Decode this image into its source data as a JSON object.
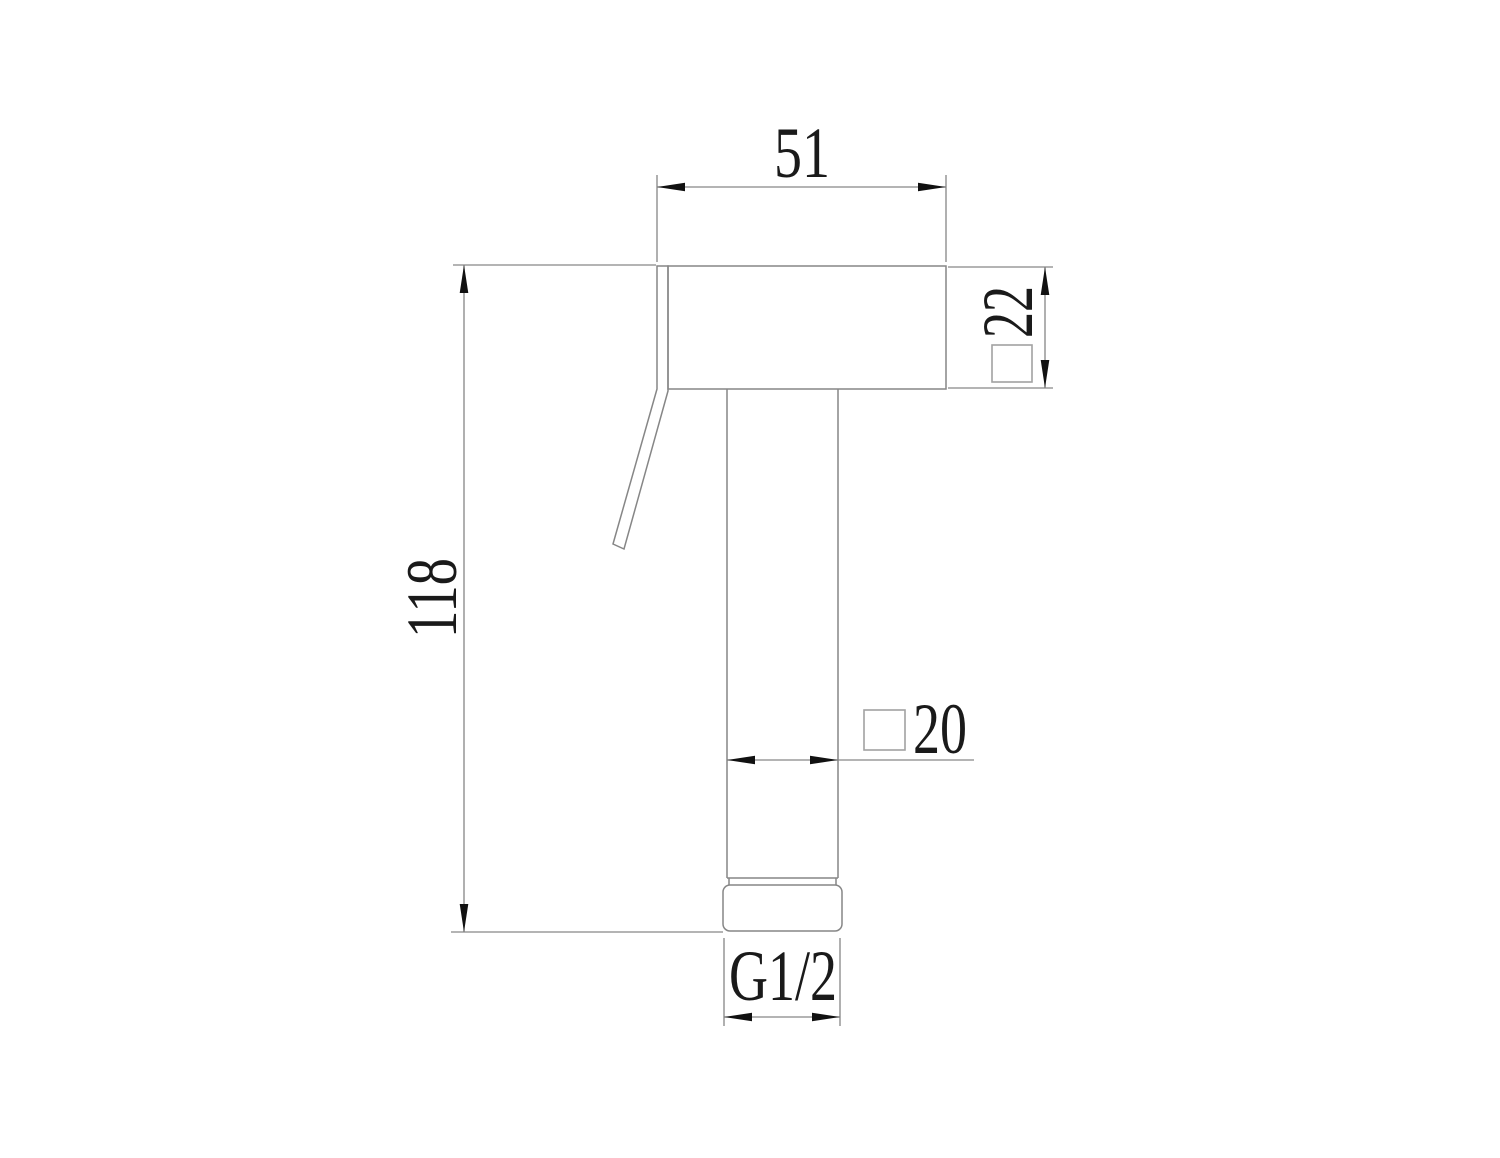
{
  "style": {
    "bg_color": "#ffffff",
    "line_color": "#868686",
    "symbol_color": "#a2a2a2",
    "text_color": "#1a1a1a",
    "arrow_color": "#111111"
  },
  "dimensions": {
    "head_width": {
      "label": "51"
    },
    "head_depth": {
      "label": "22",
      "section": "square"
    },
    "overall_height": {
      "label": "118"
    },
    "shaft_width": {
      "label": "20",
      "section": "square"
    },
    "thread_size": {
      "label": "G1/2"
    }
  }
}
